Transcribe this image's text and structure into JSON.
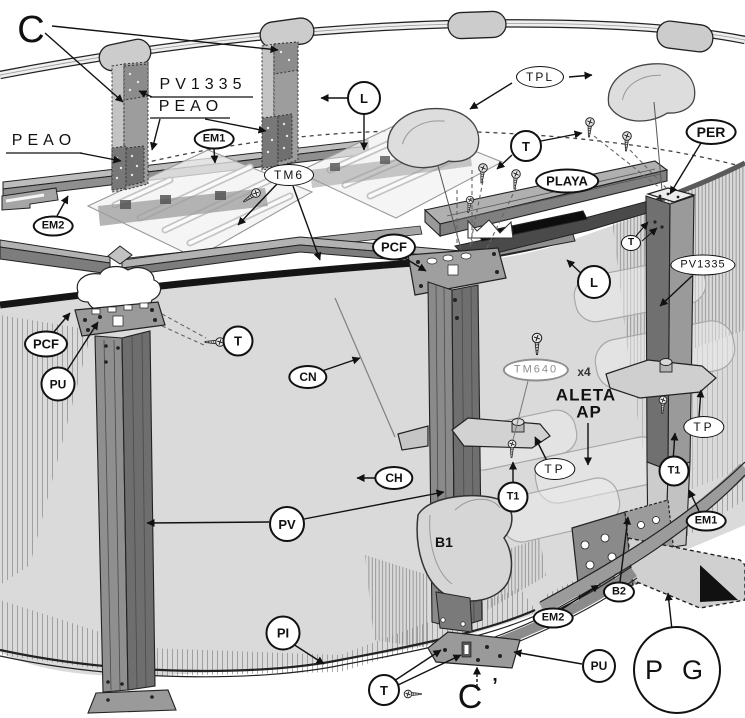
{
  "labels": {
    "c_top": "C",
    "pv1335_top": "PV1335",
    "peao_top": "PEAO",
    "peao_left": "PEAO",
    "em1_top": "EM1",
    "em2_left": "EM2",
    "tm6": "TM6",
    "l_top": "L",
    "tpl": "TPL",
    "t_top": "T",
    "playa": "PLAYA",
    "per": "PER",
    "pcf_center": "PCF",
    "l_right": "L",
    "pv1335_right": "PV1335",
    "t_right_small": "T",
    "pcf_left": "PCF",
    "pu_left": "PU",
    "t_left": "T",
    "cn": "CN",
    "tm640": "TM640",
    "tm640_qty": "x4",
    "aleta_line1": "ALETA",
    "aleta_line2": "AP",
    "ch": "CH",
    "pv": "PV",
    "tp_left": "TP",
    "tp_right": "TP",
    "t1_left": "T1",
    "t1_right": "T1",
    "b1": "B1",
    "em1_right": "EM1",
    "em2_bottom": "EM2",
    "b2": "B2",
    "pi": "PI",
    "pu_bottom": "PU",
    "t_bottom": "T",
    "c_prime": "C",
    "c_prime_mark": "’",
    "pg": "P G"
  },
  "colors": {
    "line": "#1a1a1a",
    "wall": "#d9d9d9",
    "part_dark": "#6f6f6f",
    "part_mid": "#9a9a9a",
    "part_light": "#cfcfcf",
    "ghost": "#ececec",
    "background": "#ffffff"
  }
}
